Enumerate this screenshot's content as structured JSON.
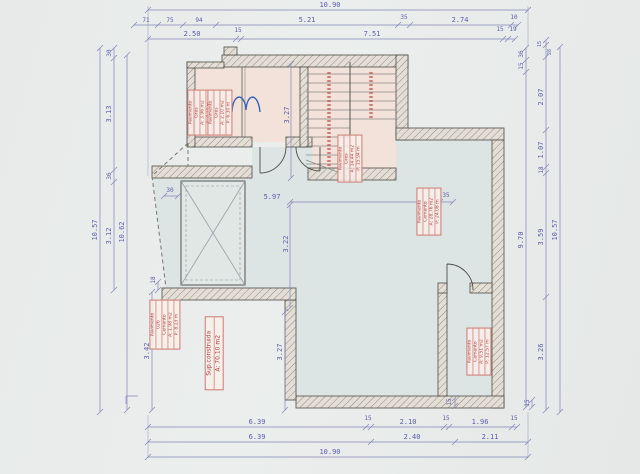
{
  "drawing": {
    "type": "architectural floor plan, scanned CAD drawing",
    "colors": {
      "paper": "#e9eceb",
      "room_pink": "#f3e2da",
      "room_blue": "#dde4e4",
      "dim_blue": "#5b5baa",
      "annotation_red": "#b23d3d",
      "wall_line": "#4c4c48",
      "fixture_blue": "#3a62b8"
    },
    "dims": {
      "top_total": "10.90",
      "top2": [
        "71",
        "75",
        "94",
        "5.21",
        "35",
        "2.74",
        "10"
      ],
      "top3": [
        "2.50",
        "15",
        "7.51",
        "15",
        "19"
      ],
      "bottom1": [
        "6.39",
        "15",
        "2.10",
        "15",
        "1.96",
        "15"
      ],
      "bottom2": [
        "6.39",
        "2.40",
        "2.11"
      ],
      "bottom_total": "10.90",
      "bottom_wall": "15",
      "left_total": "10.57",
      "left2": [
        "30",
        "3.13",
        "36",
        "3.12",
        "18",
        "3.42"
      ],
      "left3": "10.62",
      "right_total": "10.57",
      "right2": [
        "36",
        "15",
        "9.70",
        "15"
      ],
      "right3": [
        "15",
        "28",
        "2.07",
        "1.07",
        "18",
        "3.59",
        "3.26"
      ],
      "int_w": "5.97",
      "int_wall": "35",
      "int_h_top": "3.27",
      "int_h_mid": "3.22",
      "int_h_bot": "3.27",
      "int_small": "30"
    },
    "labels": {
      "sup": [
        "Sup.construida",
        "A: 70.10 m2"
      ],
      "room_a": [
        "Pavimento",
        "Gres",
        "A: 3.96 m2",
        "P: 8.10 m"
      ],
      "room_b": [
        "Pavimento",
        "Gres",
        "A: 2.10 m2",
        "P: 6.30 m"
      ],
      "stairs": [
        "Pavimento",
        "Gres",
        "A: 14.44 m2",
        "P: 15.94 m"
      ],
      "hall": [
        "Pavimento",
        "Cemento",
        "A: 28.76 m2",
        "P: 24.08 m"
      ],
      "store": [
        "Pavimento",
        "026",
        "Cemento",
        "A: 1.98 m2",
        "P: 8.13 m"
      ],
      "garage": [
        "Pavimento",
        "Cemento",
        "A: 9.51 m2",
        "P: 12.57 m"
      ]
    }
  }
}
